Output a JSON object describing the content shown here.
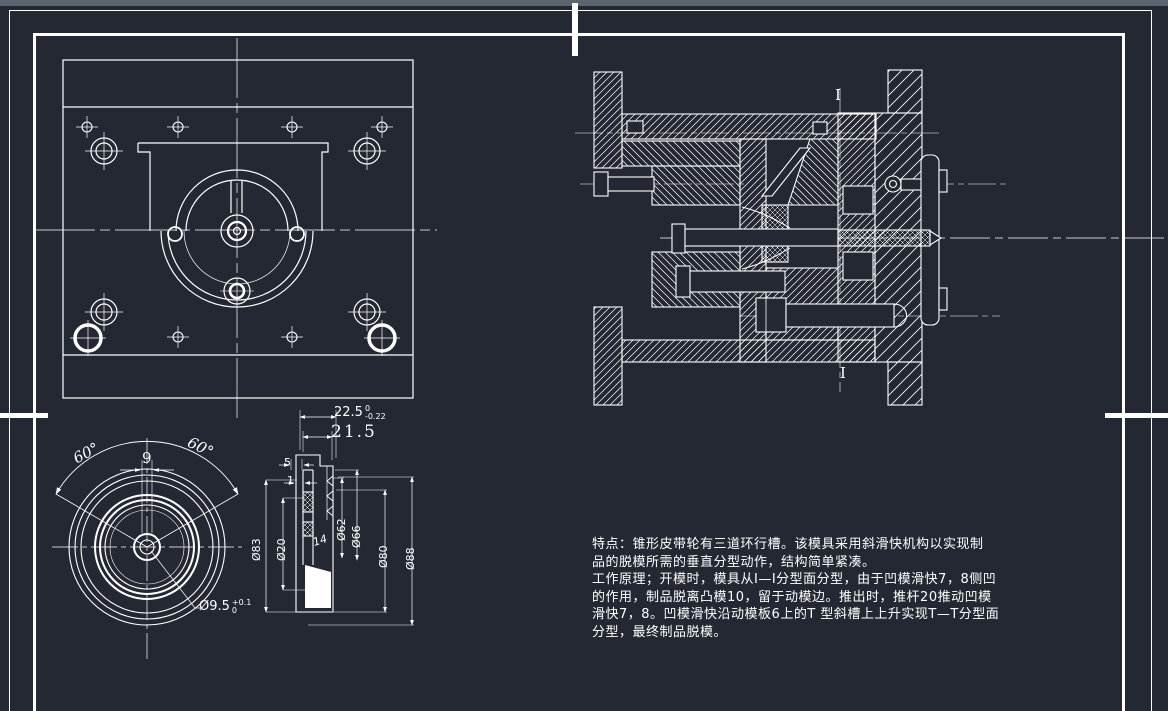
{
  "colors": {
    "background": "#232833",
    "lines": "#ffffff",
    "top_edge": "#5b6572"
  },
  "dimensions": {
    "height_toleranced": {
      "value": "22.5",
      "tol_upper": "0",
      "tol_lower": "-0.22"
    },
    "height_inner": "21.5",
    "step_5": "5",
    "step_1": "1",
    "dia_83": "Ø83",
    "dia_20": "Ø20",
    "dia_62": "Ø62",
    "dia_66": "Ø66",
    "dia_80": "Ø80",
    "dia_88": "Ø88",
    "taper": "14",
    "angle_left": "60°",
    "angle_right": "60°",
    "slot_width": "9",
    "bore": {
      "value": "Ø9.5",
      "tol_upper": "+0.1",
      "tol_lower": "0"
    }
  },
  "section_marks": {
    "top": "I",
    "bottom": "I"
  },
  "notes": {
    "lines": [
      "特点：锥形皮带轮有三道环行槽。该模具采用斜滑快机构以实现制",
      "品的脱模所需的垂直分型动作，结构简单紧凑。",
      "工作原理；开模时，模具从I—I分型面分型，由于凹模滑快7，8侧凹",
      "的作用，制品脱离凸模10，留于动模边。推出时，推杆20推动凹模",
      "滑快7，8。凹模滑快沿动模板6上的T 型斜槽上上升实现T—T分型面",
      "分型，最终制品脱模。"
    ]
  }
}
